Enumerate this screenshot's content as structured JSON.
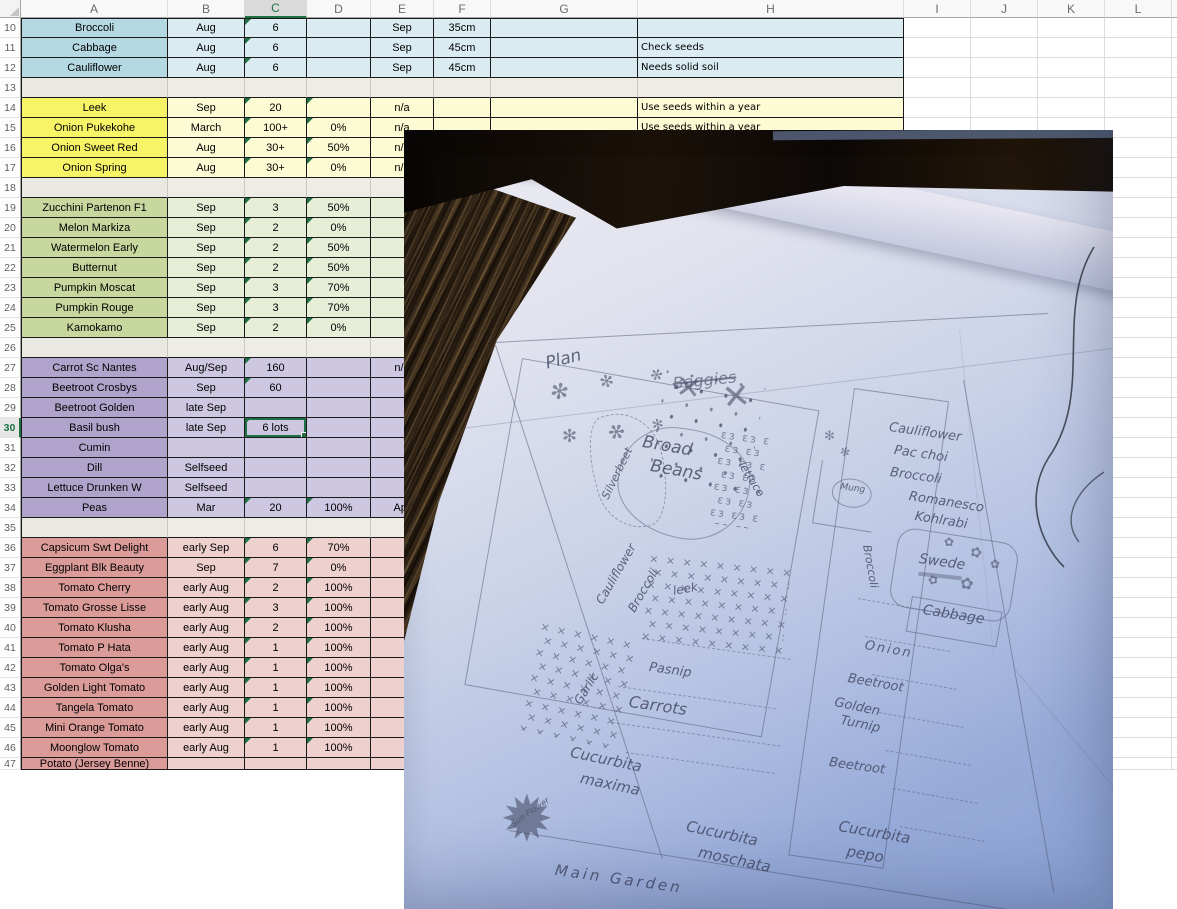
{
  "sheet": {
    "row_header_width": 21,
    "header_height": 18,
    "row_height": 20,
    "columns": [
      {
        "label": "A",
        "w": 147
      },
      {
        "label": "B",
        "w": 77
      },
      {
        "label": "C",
        "w": 62,
        "selected": true
      },
      {
        "label": "D",
        "w": 64
      },
      {
        "label": "E",
        "w": 63
      },
      {
        "label": "F",
        "w": 57
      },
      {
        "label": "G",
        "w": 147
      },
      {
        "label": "H",
        "w": 266
      },
      {
        "label": "I",
        "w": 67
      },
      {
        "label": "J",
        "w": 67
      },
      {
        "label": "K",
        "w": 67
      },
      {
        "label": "L",
        "w": 67
      },
      {
        "label": "",
        "w": 6
      }
    ],
    "selected_cell": {
      "row": "30",
      "col": "C",
      "value": "6 lots"
    },
    "accent_green": "#1e7145",
    "groups": {
      "blue": {
        "a": "#b5d9e3",
        "b": "#daecf2"
      },
      "gray": {
        "a": "#e9e8e1",
        "b": "#edece5"
      },
      "yellow": {
        "a": "#f8f468",
        "b": "#fcfbd4"
      },
      "green": {
        "a": "#c7d79e",
        "b": "#e6eed8"
      },
      "purple": {
        "a": "#b1a4cc",
        "b": "#cec7e1"
      },
      "red": {
        "a": "#db9c99",
        "b": "#eed0ce"
      }
    },
    "rows": [
      {
        "n": "10",
        "g": "blue",
        "A": "Broccoli",
        "B": "Aug",
        "C": "6",
        "E": "Sep",
        "F": "35cm",
        "flags": [
          "C"
        ]
      },
      {
        "n": "11",
        "g": "blue",
        "A": "Cabbage",
        "B": "Aug",
        "C": "6",
        "E": "Sep",
        "F": "45cm",
        "H": "Check seeds",
        "flags": [
          "C"
        ]
      },
      {
        "n": "12",
        "g": "blue",
        "A": "Cauliflower",
        "B": "Aug",
        "C": "6",
        "E": "Sep",
        "F": "45cm",
        "H": "Needs solid soil",
        "flags": [
          "C"
        ]
      },
      {
        "n": "13",
        "g": "gray"
      },
      {
        "n": "14",
        "g": "yellow",
        "A": "Leek",
        "B": "Sep",
        "C": "20",
        "E": "n/a",
        "H": "Use seeds within a year",
        "flags": [
          "C",
          "D"
        ]
      },
      {
        "n": "15",
        "g": "yellow",
        "A": "Onion Pukekohe",
        "B": "March",
        "C": "100+",
        "D": "0%",
        "E": "n/a",
        "H": "Use seeds within a year",
        "flags": [
          "C",
          "D"
        ]
      },
      {
        "n": "16",
        "g": "yellow",
        "A": "Onion Sweet Red",
        "B": "Aug",
        "C": "30+",
        "D": "50%",
        "E": "n/a",
        "flags": [
          "C",
          "D"
        ]
      },
      {
        "n": "17",
        "g": "yellow",
        "A": "Onion Spring",
        "B": "Aug",
        "C": "30+",
        "D": "0%",
        "E": "n/a",
        "flags": [
          "C",
          "D"
        ]
      },
      {
        "n": "18",
        "g": "gray"
      },
      {
        "n": "19",
        "g": "green",
        "A": "Zucchini Partenon F1",
        "B": "Sep",
        "C": "3",
        "D": "50%",
        "flags": [
          "C",
          "D"
        ]
      },
      {
        "n": "20",
        "g": "green",
        "A": "Melon Markiza",
        "B": "Sep",
        "C": "2",
        "D": "0%",
        "flags": [
          "C",
          "D"
        ]
      },
      {
        "n": "21",
        "g": "green",
        "A": "Watermelon Early",
        "B": "Sep",
        "C": "2",
        "D": "50%",
        "flags": [
          "C",
          "D"
        ]
      },
      {
        "n": "22",
        "g": "green",
        "A": "Butternut",
        "B": "Sep",
        "C": "2",
        "D": "50%",
        "flags": [
          "C",
          "D"
        ]
      },
      {
        "n": "23",
        "g": "green",
        "A": "Pumpkin Moscat",
        "B": "Sep",
        "C": "3",
        "D": "70%",
        "flags": [
          "C",
          "D"
        ]
      },
      {
        "n": "24",
        "g": "green",
        "A": "Pumpkin Rouge",
        "B": "Sep",
        "C": "3",
        "D": "70%",
        "flags": [
          "C",
          "D"
        ]
      },
      {
        "n": "25",
        "g": "green",
        "A": "Kamokamo",
        "B": "Sep",
        "C": "2",
        "D": "0%",
        "flags": [
          "C",
          "D"
        ]
      },
      {
        "n": "26",
        "g": "gray"
      },
      {
        "n": "27",
        "g": "purple",
        "A": "Carrot Sc Nantes",
        "B": "Aug/Sep",
        "C": "160",
        "E": "n/a",
        "flags": [
          "C"
        ]
      },
      {
        "n": "28",
        "g": "purple",
        "A": "Beetroot Crosbys",
        "B": "Sep",
        "C": "60",
        "flags": [
          "C"
        ]
      },
      {
        "n": "29",
        "g": "purple",
        "A": "Beetroot Golden",
        "B": "late Sep"
      },
      {
        "n": "30",
        "g": "purple",
        "A": "Basil bush",
        "B": "late Sep",
        "C": "6 lots",
        "flags": [
          "C"
        ],
        "sel": "C"
      },
      {
        "n": "31",
        "g": "purple",
        "A": "Cumin"
      },
      {
        "n": "32",
        "g": "purple",
        "A": "Dill",
        "B": "Selfseed"
      },
      {
        "n": "33",
        "g": "purple",
        "A": "Lettuce Drunken W",
        "B": "Selfseed"
      },
      {
        "n": "34",
        "g": "purple",
        "A": "Peas",
        "B": "Mar",
        "C": "20",
        "D": "100%",
        "E": "Apr",
        "flags": [
          "C",
          "D"
        ]
      },
      {
        "n": "35",
        "g": "gray"
      },
      {
        "n": "36",
        "g": "red",
        "A": "Capsicum Swt Delight",
        "B": "early Sep",
        "C": "6",
        "D": "70%",
        "flags": [
          "C",
          "D"
        ]
      },
      {
        "n": "37",
        "g": "red",
        "A": "Eggplant Blk Beauty",
        "B": "Sep",
        "C": "7",
        "D": "0%",
        "flags": [
          "C",
          "D"
        ]
      },
      {
        "n": "38",
        "g": "red",
        "A": "Tomato Cherry",
        "B": "early Aug",
        "C": "2",
        "D": "100%",
        "flags": [
          "C",
          "D"
        ]
      },
      {
        "n": "39",
        "g": "red",
        "A": "Tomato Grosse Lisse",
        "B": "early Aug",
        "C": "3",
        "D": "100%",
        "flags": [
          "C",
          "D"
        ]
      },
      {
        "n": "40",
        "g": "red",
        "A": "Tomato Klusha",
        "B": "early Aug",
        "C": "2",
        "D": "100%",
        "flags": [
          "C",
          "D"
        ]
      },
      {
        "n": "41",
        "g": "red",
        "A": "Tomato P Hata",
        "B": "early Aug",
        "C": "1",
        "D": "100%",
        "flags": [
          "C",
          "D"
        ]
      },
      {
        "n": "42",
        "g": "red",
        "A": "Tomato Olga's",
        "B": "early Aug",
        "C": "1",
        "D": "100%",
        "flags": [
          "C",
          "D"
        ]
      },
      {
        "n": "43",
        "g": "red",
        "A": "Golden Light Tomato",
        "B": "early Aug",
        "C": "1",
        "D": "100%",
        "flags": [
          "C",
          "D"
        ]
      },
      {
        "n": "44",
        "g": "red",
        "A": "Tangela Tomato",
        "B": "early Aug",
        "C": "1",
        "D": "100%",
        "flags": [
          "C",
          "D"
        ]
      },
      {
        "n": "45",
        "g": "red",
        "A": "Mini Orange Tomato",
        "B": "early Aug",
        "C": "1",
        "D": "100%",
        "flags": [
          "C",
          "D"
        ]
      },
      {
        "n": "46",
        "g": "red",
        "A": "Moonglow Tomato",
        "B": "early Aug",
        "C": "1",
        "D": "100%",
        "flags": [
          "C",
          "D"
        ]
      },
      {
        "n": "47",
        "g": "red",
        "A": "Potato (Jersey Benne)",
        "partial": true
      }
    ]
  },
  "photo": {
    "frame": {
      "left": 404,
      "top": 130,
      "width": 709,
      "height": 779
    },
    "colors": {
      "paper_top": "#edecf3",
      "paper_bottom": "#8ba3d6",
      "wood": "#2f2315",
      "band": "#120c08",
      "pencil": "#4a506a"
    },
    "labels": [
      {
        "t": "Plan",
        "x": 140,
        "y": 226,
        "s": 17,
        "r": -14
      },
      {
        "t": "Baggies",
        "x": 268,
        "y": 246,
        "s": 16,
        "r": -6,
        "strike": true
      },
      {
        "t": "Silverbeet",
        "x": 196,
        "y": 366,
        "s": 11,
        "r": -64
      },
      {
        "t": "Broad",
        "x": 240,
        "y": 304,
        "s": 17,
        "r": 10
      },
      {
        "t": "Beans",
        "x": 248,
        "y": 328,
        "s": 17,
        "r": 10
      },
      {
        "t": "lettuce",
        "x": 342,
        "y": 330,
        "s": 11,
        "r": 58
      },
      {
        "t": "Cauliflower",
        "x": 190,
        "y": 470,
        "s": 12,
        "r": -60
      },
      {
        "t": "Broccoli",
        "x": 222,
        "y": 478,
        "s": 12,
        "r": -60
      },
      {
        "t": "Garlic",
        "x": 168,
        "y": 570,
        "s": 12,
        "r": -58
      },
      {
        "t": "leek",
        "x": 268,
        "y": 455,
        "s": 12,
        "r": -10
      },
      {
        "t": "Pasnip",
        "x": 246,
        "y": 531,
        "s": 13,
        "r": 8
      },
      {
        "t": "Carrots",
        "x": 226,
        "y": 564,
        "s": 16,
        "r": 8
      },
      {
        "t": "Cucurbita",
        "x": 168,
        "y": 615,
        "s": 15,
        "r": 12
      },
      {
        "t": "maxima",
        "x": 178,
        "y": 641,
        "s": 15,
        "r": 12
      },
      {
        "t": "Sun Flower",
        "x": 106,
        "y": 692,
        "s": 8,
        "r": -35
      },
      {
        "t": "Main Garden",
        "x": 152,
        "y": 733,
        "s": 15,
        "r": 8,
        "ls": 3
      },
      {
        "t": "Cucurbita",
        "x": 284,
        "y": 689,
        "s": 15,
        "r": 12
      },
      {
        "t": "moschata",
        "x": 296,
        "y": 715,
        "s": 15,
        "r": 12
      },
      {
        "t": "Cucurbita",
        "x": 436,
        "y": 689,
        "s": 15,
        "r": 10
      },
      {
        "t": "pepo",
        "x": 444,
        "y": 714,
        "s": 15,
        "r": 10
      },
      {
        "t": "Cauliflower",
        "x": 486,
        "y": 291,
        "s": 13,
        "r": 8
      },
      {
        "t": "Pac choi",
        "x": 491,
        "y": 314,
        "s": 13,
        "r": 8
      },
      {
        "t": "Broccoli",
        "x": 487,
        "y": 336,
        "s": 13,
        "r": 8
      },
      {
        "t": "Romanesco",
        "x": 506,
        "y": 360,
        "s": 13,
        "r": 9
      },
      {
        "t": "Kohlrabi",
        "x": 512,
        "y": 380,
        "s": 13,
        "r": 9
      },
      {
        "t": "Swede",
        "x": 516,
        "y": 422,
        "s": 14,
        "r": 8
      },
      {
        "t": "Cabbage",
        "x": 520,
        "y": 473,
        "s": 14,
        "r": 9
      },
      {
        "t": "Broccoli",
        "x": 468,
        "y": 414,
        "s": 11,
        "r": 80
      },
      {
        "t": "Onion",
        "x": 462,
        "y": 509,
        "s": 13,
        "r": 10,
        "ls": 2
      },
      {
        "t": "Beetroot",
        "x": 445,
        "y": 542,
        "s": 13,
        "r": 10
      },
      {
        "t": "Golden",
        "x": 432,
        "y": 566,
        "s": 13,
        "r": 12
      },
      {
        "t": "Turnip",
        "x": 438,
        "y": 584,
        "s": 13,
        "r": 12
      },
      {
        "t": "Beetroot",
        "x": 426,
        "y": 626,
        "s": 13,
        "r": 8
      },
      {
        "t": "Mung",
        "x": 437,
        "y": 353,
        "s": 9,
        "r": 8
      }
    ],
    "doodles": [
      {
        "g": "✻",
        "x": 146,
        "y": 252,
        "s": 22,
        "r": 10
      },
      {
        "g": "✻",
        "x": 196,
        "y": 244,
        "s": 17,
        "r": -15
      },
      {
        "g": "✻",
        "x": 246,
        "y": 238,
        "s": 15,
        "r": 20
      },
      {
        "g": "✻",
        "x": 158,
        "y": 298,
        "s": 18,
        "r": 0
      },
      {
        "g": "✻",
        "x": 204,
        "y": 292,
        "s": 20,
        "r": 25
      },
      {
        "g": "✻",
        "x": 248,
        "y": 288,
        "s": 14,
        "r": -10
      },
      {
        "g": "✕",
        "x": 272,
        "y": 244,
        "s": 30,
        "r": 8
      },
      {
        "g": "✕",
        "x": 318,
        "y": 250,
        "s": 34,
        "r": -6
      },
      {
        "g": "✹",
        "x": 96,
        "y": 658,
        "s": 64,
        "r": 0
      },
      {
        "g": "✿",
        "x": 540,
        "y": 406,
        "s": 12,
        "r": 0
      },
      {
        "g": "✿",
        "x": 566,
        "y": 416,
        "s": 14,
        "r": 20
      },
      {
        "g": "✿",
        "x": 524,
        "y": 444,
        "s": 12,
        "r": -15
      },
      {
        "g": "✿",
        "x": 556,
        "y": 446,
        "s": 16,
        "r": 10
      },
      {
        "g": "✿",
        "x": 586,
        "y": 428,
        "s": 12,
        "r": 0
      },
      {
        "g": "✻",
        "x": 420,
        "y": 300,
        "s": 13,
        "r": 0
      },
      {
        "g": "✻",
        "x": 436,
        "y": 316,
        "s": 12,
        "r": 15
      }
    ],
    "patches": [
      {
        "name": "leek-xhatch",
        "char": "× ",
        "x": 246,
        "y": 422,
        "w": 142,
        "h": 88,
        "r": 6
      },
      {
        "name": "garlic-xhatch",
        "char": "× ",
        "x": 138,
        "y": 490,
        "w": 98,
        "h": 112,
        "r": 12
      },
      {
        "name": "lettuce-curls",
        "char": "εз ",
        "x": 318,
        "y": 298,
        "w": 48,
        "h": 96,
        "r": 8
      }
    ]
  }
}
